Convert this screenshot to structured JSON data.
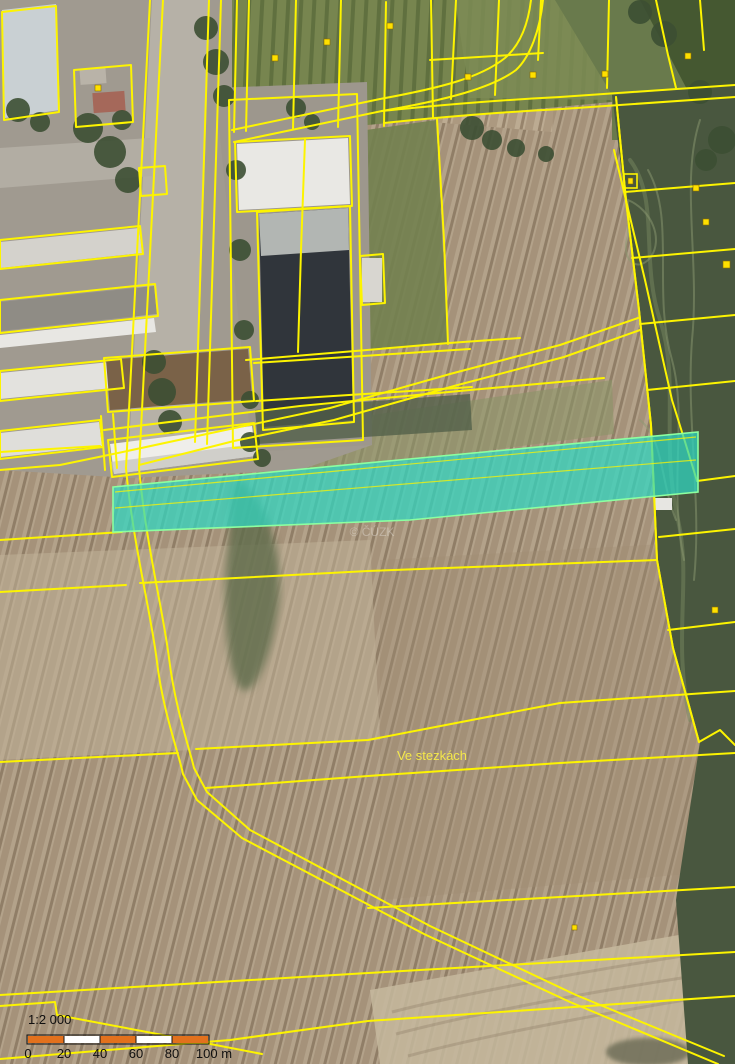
{
  "map": {
    "field_label": "Ve stezkách",
    "watermark": "© ČÚZK",
    "parcel_line_color": "#FDF400",
    "highlighted_parcel": {
      "fill": "#2FD8C4",
      "outline": "#8CFFA0"
    }
  },
  "scalebar": {
    "ratio": "1:2 000",
    "ticks": [
      "0",
      "20",
      "40",
      "60",
      "80",
      "100 m"
    ],
    "bar_colors": [
      "#E2711D",
      "#FFFFFF",
      "#E2711D",
      "#FFFFFF",
      "#E2711D"
    ],
    "segment_length_m": 20,
    "total_length_m": 100
  }
}
